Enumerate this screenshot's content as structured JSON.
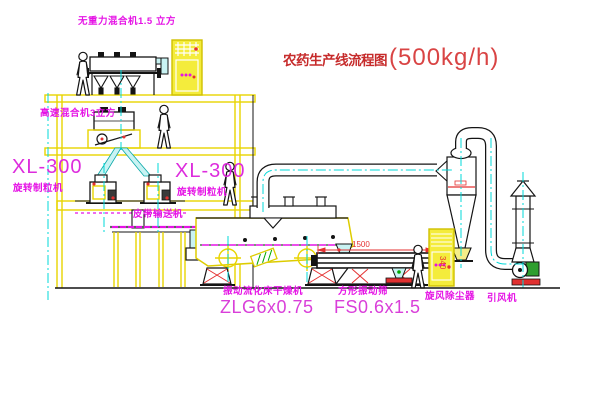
{
  "colors": {
    "background": "#ffffff",
    "structure_yellow": "#e8d400",
    "cabinet_yellow": "#f4ec3c",
    "label_magenta": "#e513e5",
    "title_red": "#c62b2b",
    "dimension_red": "#e43131",
    "centerline_cyan": "#00d8d8",
    "chute_cyan_fill": "#c9f3f3",
    "accent_green": "#00a800",
    "line_black": "#141414"
  },
  "title": {
    "name": "农药生产线流程图",
    "capacity": "(500kg/h)"
  },
  "equipment_labels": {
    "gravity_mixer": "无重力混合机1.5 立方",
    "high_speed_mixer": "高速混合机3立方",
    "granulator_left_model": "XL-300",
    "granulator_left_name": "旋转制粒机",
    "granulator_right_model": "XL-300",
    "granulator_right_name": "旋转制粒机",
    "belt_conveyor": "皮带输送机",
    "dryer_name": "振动流化床干燥机",
    "dryer_model": "ZLG6x0.75",
    "screen_name": "方形振动筛",
    "screen_model": "FS0.6x1.5",
    "cyclone": "旋风除尘器",
    "induced_draft_fan": "引风机"
  },
  "dimensions": {
    "screen_length": "1500",
    "screen_height": "340"
  }
}
